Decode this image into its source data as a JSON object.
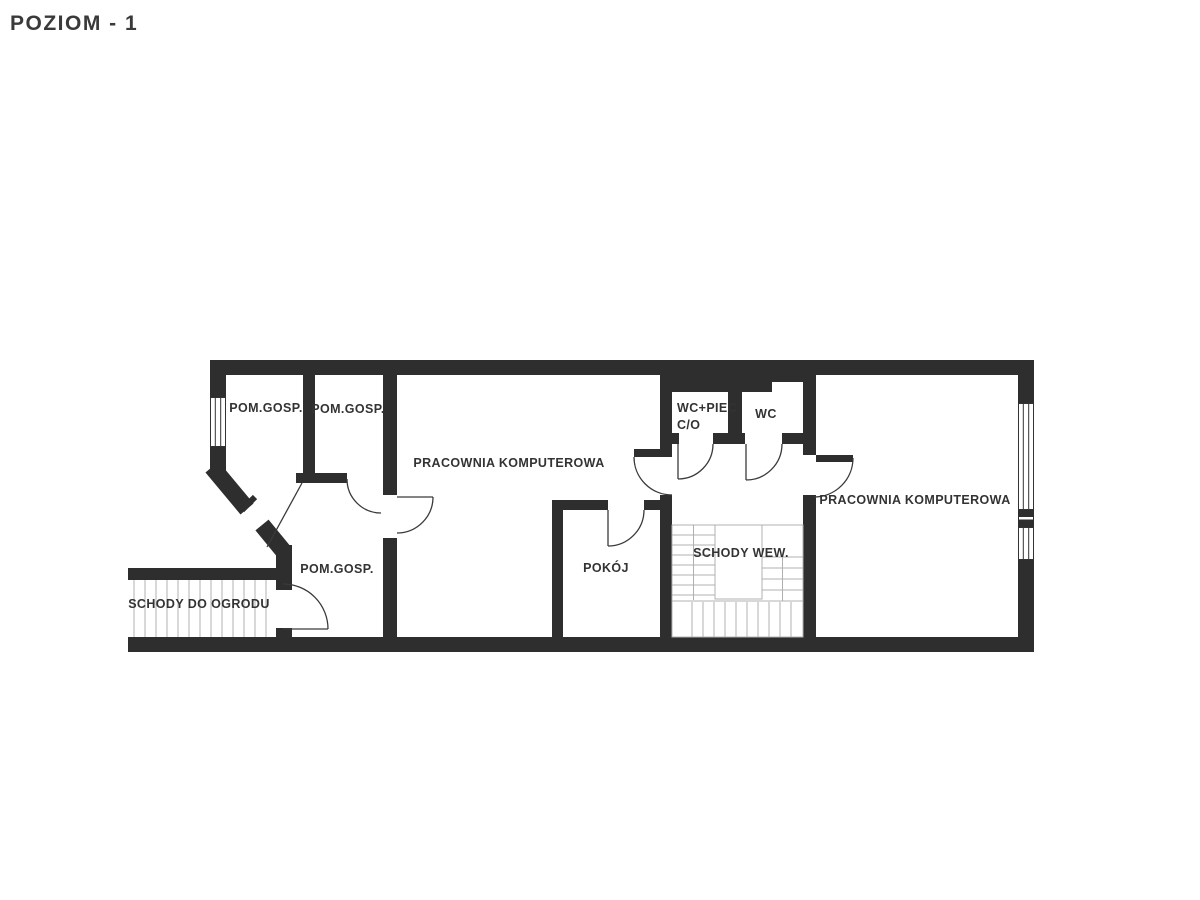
{
  "page": {
    "title": "POZIOM - 1"
  },
  "plan": {
    "rooms": [
      {
        "id": "pom-gosp-1",
        "label": "POM.GOSP."
      },
      {
        "id": "pom-gosp-2",
        "label": "POM.GOSP."
      },
      {
        "id": "pracownia-left",
        "label": "PRACOWNIA KOMPUTEROWA"
      },
      {
        "id": "wc-piec",
        "label": "WC+PIEC",
        "label2": "C/O"
      },
      {
        "id": "wc",
        "label": "WC"
      },
      {
        "id": "pracownia-right",
        "label": "PRACOWNIA KOMPUTEROWA"
      },
      {
        "id": "pom-gosp-3",
        "label": "POM.GOSP."
      },
      {
        "id": "pokoj",
        "label": "POKÓJ"
      },
      {
        "id": "schody-wew",
        "label": "SCHODY WEW."
      },
      {
        "id": "schody-ogrod",
        "label": "SCHODY DO OGRODU"
      }
    ],
    "colors": {
      "wall": "#2e2e2e",
      "door_arc": "#3a3a3a",
      "stair_lines": "#b0b0b0",
      "label_text": "#333333",
      "title_text": "#3a3a3a",
      "background": "#ffffff"
    }
  }
}
